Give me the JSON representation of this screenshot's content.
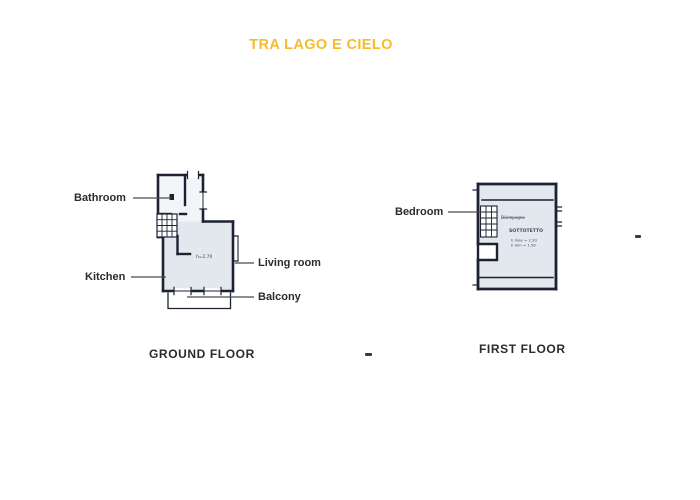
{
  "title": "TRA LAGO E CIELO",
  "colors": {
    "title_accent": "#f5bb2b",
    "label_text": "#2b2b2b",
    "plan_wall": "#1d2233",
    "plan_room_fill": "#e3e7ee"
  },
  "ground_floor": {
    "caption": "GROUND FLOOR",
    "labels": {
      "bathroom": "Bathroom",
      "kitchen": "Kitchen",
      "living_room": "Living room",
      "balcony": "Balcony"
    },
    "annotations": {
      "height": "h=2.70"
    }
  },
  "first_floor": {
    "caption": "FIRST FLOOR",
    "labels": {
      "bedroom": "Bedroom"
    },
    "annotations": {
      "hall": "Disimpegno",
      "attic": "SOTTOTETTO",
      "h_max": "h max = 2.20",
      "h_min": "h min = 1.50"
    }
  }
}
